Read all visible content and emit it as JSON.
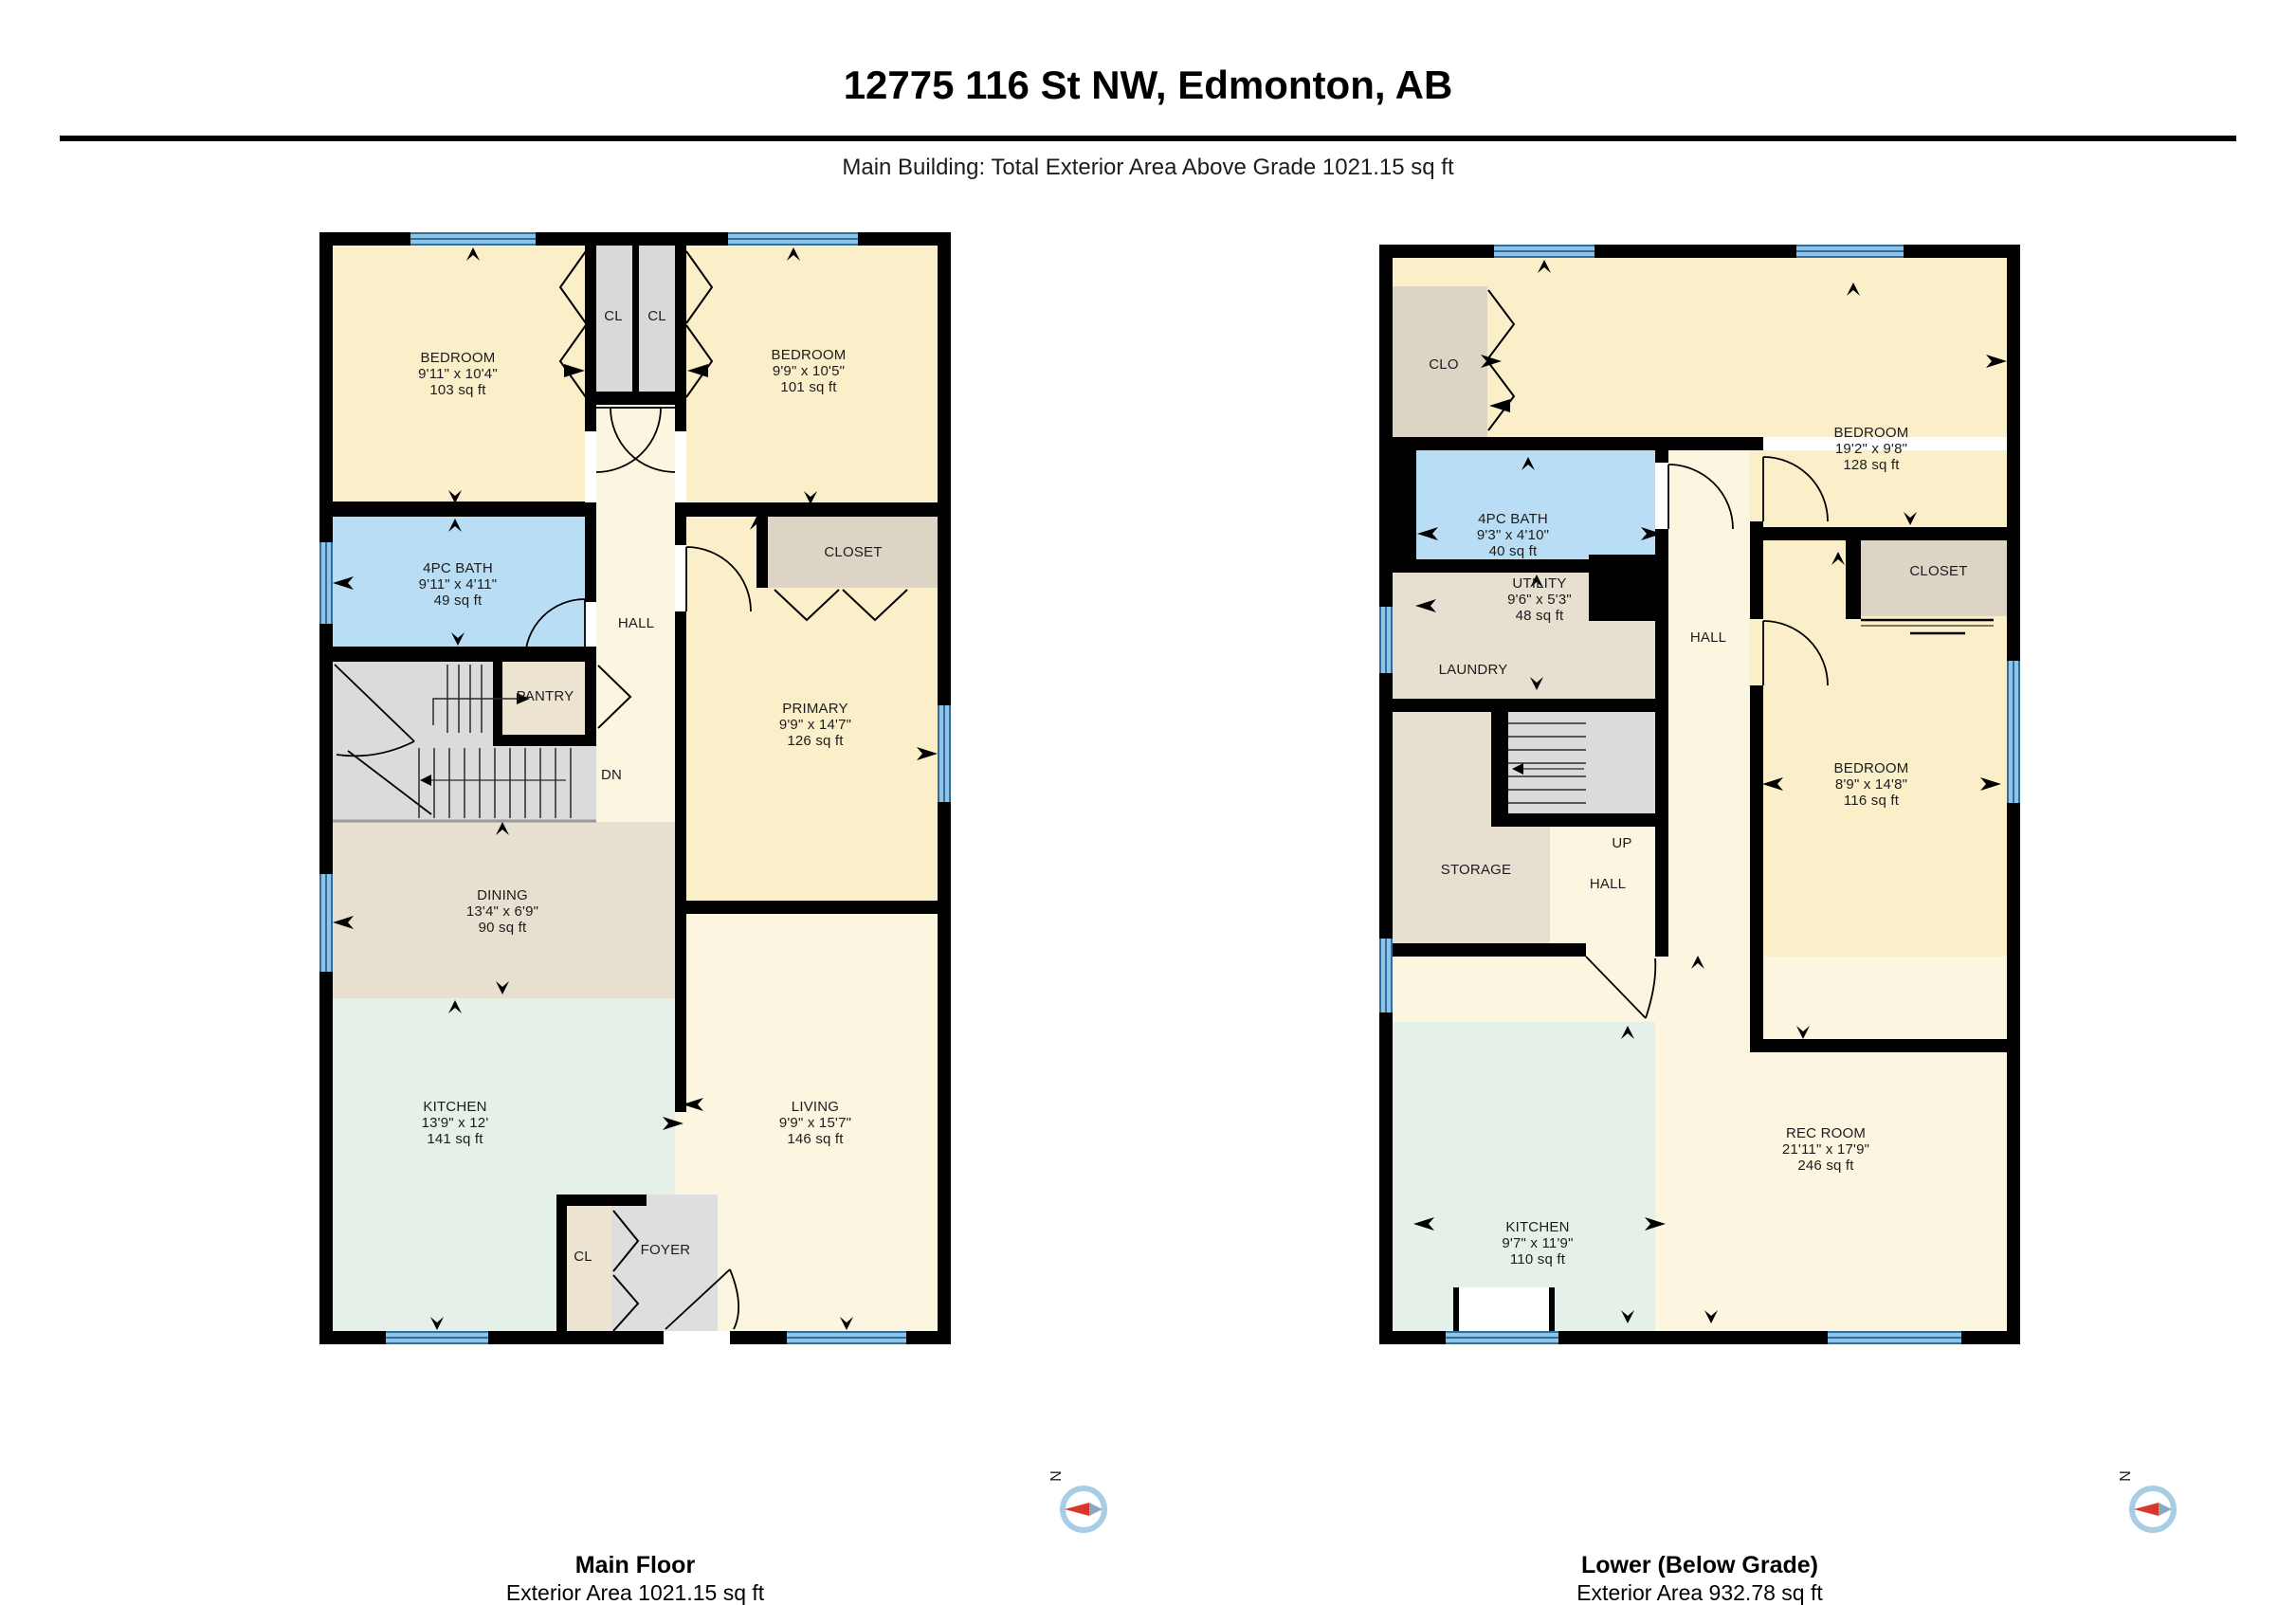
{
  "header": {
    "title": "12775 116 St NW, Edmonton, AB",
    "subtitle": "Main Building: Total Exterior Area Above Grade 1021.15 sq ft"
  },
  "compass": {
    "north_label": "N"
  },
  "colors": {
    "wall": "#000000",
    "bedroom_fill": "#FAEFC9",
    "hall_fill": "#FCF6E0",
    "bath_fill": "#B9DDF4",
    "dining_fill": "#E7DFD0",
    "pantry_fill": "#ECE3D1",
    "closet_gray": "#D9D9D9",
    "closet_tan": "#DCD5C6",
    "kitchen_fill": "#E4F0E8",
    "foyer_fill": "#DEDEDE",
    "stair_fill": "#DBDBDB",
    "window_blue": "#8FC4E6",
    "compass_red": "#D9372A"
  },
  "plans": {
    "main": {
      "caption": {
        "title": "Main Floor",
        "subtitle": "Exterior Area 1021.15 sq ft"
      },
      "rooms": {
        "bedroom_left": {
          "name": "BEDROOM",
          "dims": "9'11\" x 10'4\"",
          "area": "103 sq ft"
        },
        "bedroom_right": {
          "name": "BEDROOM",
          "dims": "9'9\" x 10'5\"",
          "area": "101 sq ft"
        },
        "bath": {
          "name": "4PC BATH",
          "dims": "9'11\" x 4'11\"",
          "area": "49 sq ft"
        },
        "primary": {
          "name": "PRIMARY",
          "dims": "9'9\" x 14'7\"",
          "area": "126 sq ft"
        },
        "dining": {
          "name": "DINING",
          "dims": "13'4\" x 6'9\"",
          "area": "90 sq ft"
        },
        "kitchen": {
          "name": "KITCHEN",
          "dims": "13'9\" x 12'",
          "area": "141 sq ft"
        },
        "living": {
          "name": "LIVING",
          "dims": "9'9\" x 15'7\"",
          "area": "146 sq ft"
        }
      },
      "labels": {
        "cl_left": "CL",
        "cl_right": "CL",
        "hall": "HALL",
        "closet": "CLOSET",
        "pantry": "PANTRY",
        "dn": "DN",
        "foyer": "FOYER",
        "cl_foyer": "CL"
      }
    },
    "lower": {
      "caption": {
        "title": "Lower (Below Grade)",
        "subtitle": "Exterior Area 932.78 sq ft"
      },
      "rooms": {
        "bedroom1": {
          "name": "BEDROOM",
          "dims": "19'2\" x 9'8\"",
          "area": "128 sq ft"
        },
        "bath": {
          "name": "4PC BATH",
          "dims": "9'3\" x 4'10\"",
          "area": "40 sq ft"
        },
        "utility": {
          "name": "UTILITY",
          "dims": "9'6\" x 5'3\"",
          "area": "48 sq ft"
        },
        "bedroom2": {
          "name": "BEDROOM",
          "dims": "8'9\" x 14'8\"",
          "area": "116 sq ft"
        },
        "kitchen": {
          "name": "KITCHEN",
          "dims": "9'7\" x 11'9\"",
          "area": "110 sq ft"
        },
        "rec": {
          "name": "REC ROOM",
          "dims": "21'11\" x 17'9\"",
          "area": "246 sq ft"
        }
      },
      "labels": {
        "clo": "CLO",
        "laundry": "LAUNDRY",
        "hall": "HALL",
        "closet": "CLOSET",
        "storage": "STORAGE",
        "up": "UP",
        "hall_lower": "HALL"
      }
    }
  }
}
